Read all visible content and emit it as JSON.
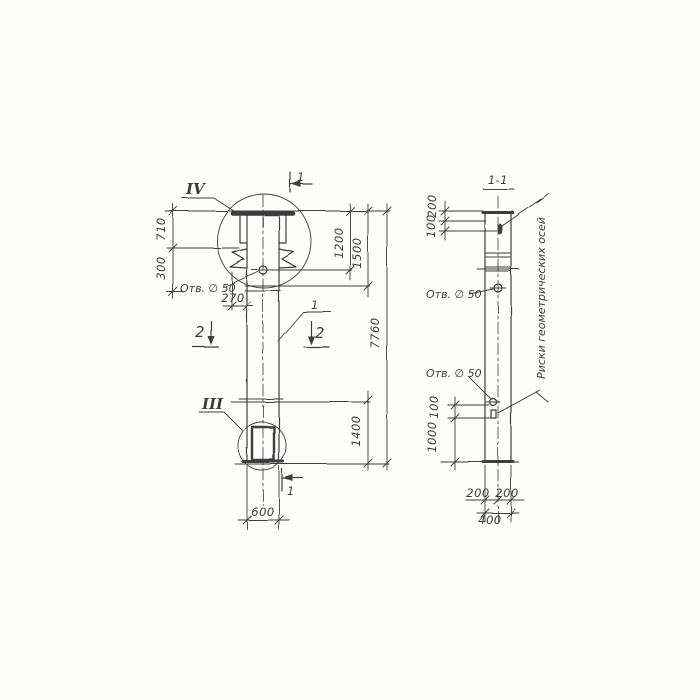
{
  "colors": {
    "ink": "#3c3c3c",
    "paper": "#fdfdfc"
  },
  "elevation": {
    "detail_top": "IV",
    "detail_bottom": "III",
    "section_cut_top": "1",
    "section_cut_bottom": "1",
    "section_cut2_left": "2",
    "section_cut2_right": "2",
    "item_mark": "1",
    "hole_note": "Отв. ∅ 50",
    "dim_710": "710",
    "dim_300": "300",
    "dim_270": "270",
    "dim_1200": "1200",
    "dim_1500": "1500",
    "dim_7760": "7760",
    "dim_1400": "1400",
    "dim_600": "600"
  },
  "section": {
    "title": "1-1",
    "hole_note_upper": "Отв. ∅ 50",
    "hole_note_lower": "Отв. ∅ 50",
    "axes_note": "Риски геометрических осей",
    "dim_200_top": "200",
    "dim_100_top": "100",
    "dim_100_mid": "100",
    "dim_1000": "1000",
    "dim_200_bottom_left": "200",
    "dim_200_bottom_right": "200",
    "dim_400": "400"
  }
}
